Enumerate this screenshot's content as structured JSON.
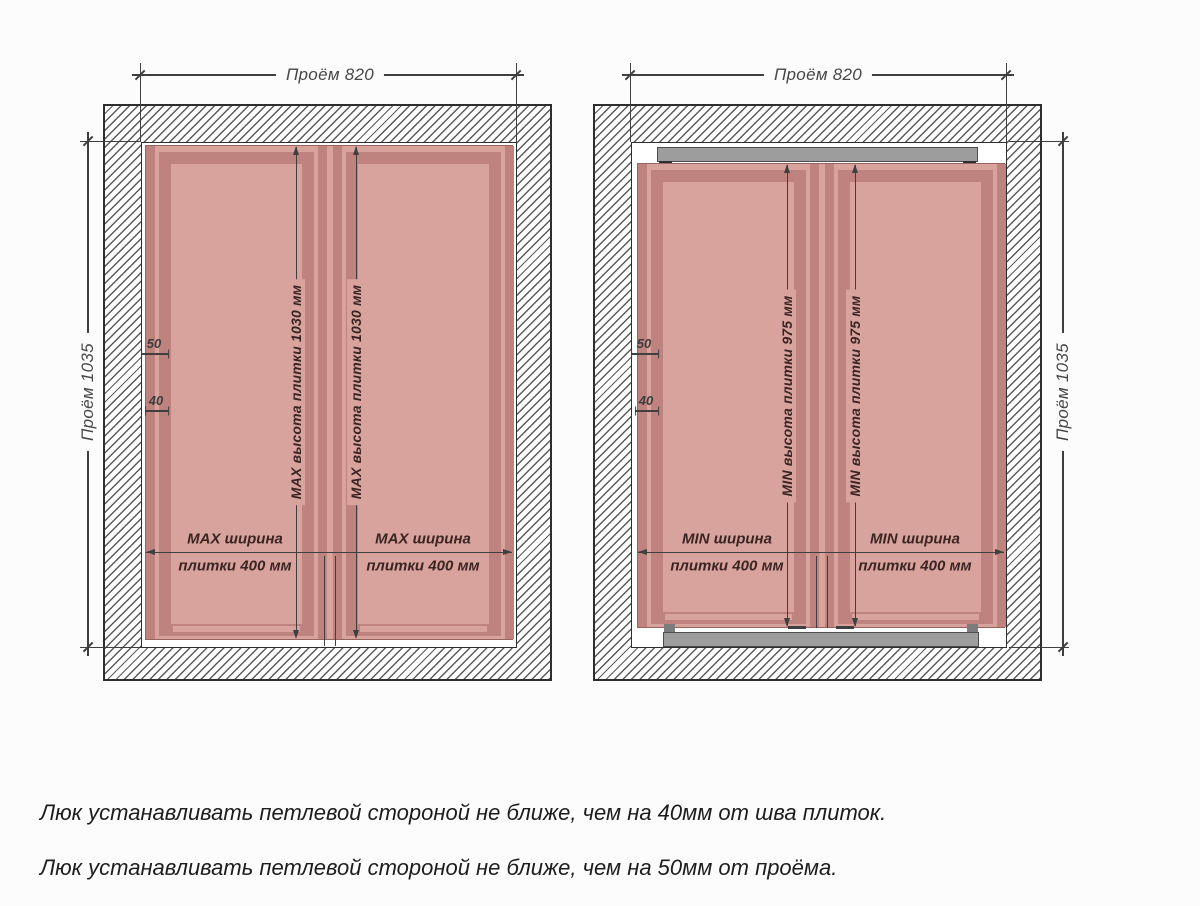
{
  "palette": {
    "tile_light": "#d9a39d",
    "tile_dark": "#bf837f",
    "wall_hatch_line": "#5a5a5a",
    "dimension_line": "#3f3f3f",
    "frame_bar_gray": "#9d9d9d",
    "note_text": "#1d1d1d"
  },
  "diagrams": {
    "left": {
      "opening_width": "Проём 820",
      "opening_height": "Проём 1035",
      "tile_height": "MAX высота плитки 1030 мм",
      "tile_width_line1": "MAX ширина",
      "tile_width_line2": "плитки 400 мм",
      "hinge_offset": "50",
      "seam_offset": "40"
    },
    "right": {
      "opening_width": "Проём 820",
      "opening_height": "Проём 1035",
      "tile_height": "MIN высота плитки 975 мм",
      "tile_width_line1": "MIN ширина",
      "tile_width_line2": "плитки 400 мм",
      "hinge_offset": "50",
      "seam_offset": "40"
    }
  },
  "notes": [
    "Люк устанавливать петлевой стороной не ближе, чем на 40мм от шва плиток.",
    "Люк устанавливать петлевой стороной не ближе, чем на 50мм от проёма."
  ]
}
